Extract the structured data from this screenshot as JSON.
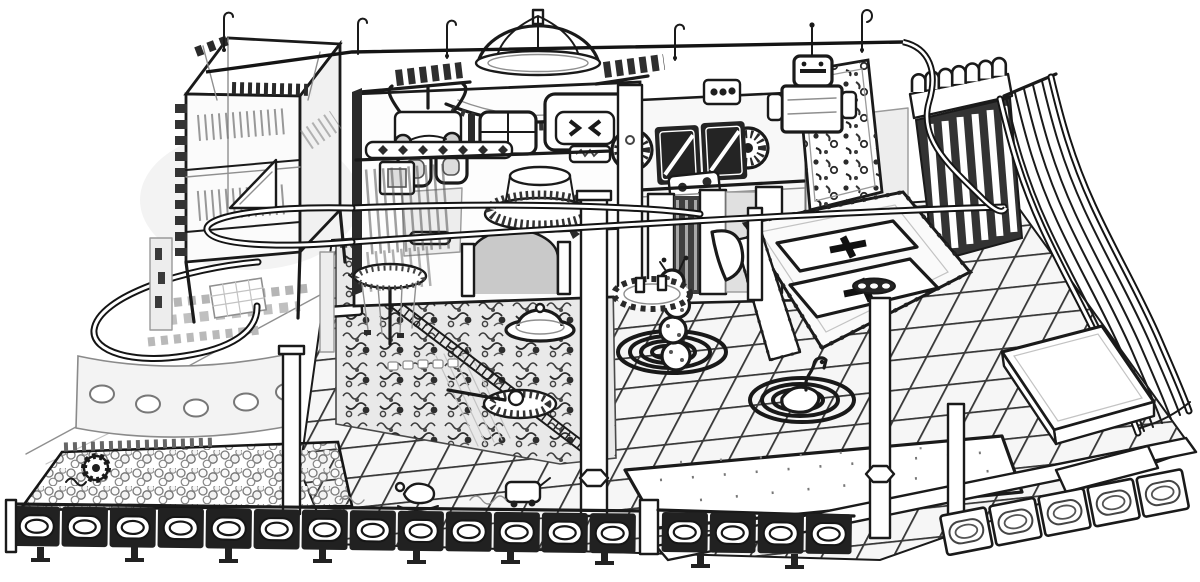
{
  "meta": {
    "description": "Black-and-white pencil edge-sketch of an indoor soft-play playground viewed in isometric perspective",
    "style": "line-art sketch",
    "background": "#ffffff",
    "ink": "#1a1a1a",
    "faint_ink": "#8f8f8f"
  },
  "labels": {
    "panel_number": "20"
  },
  "scene": {
    "regions": [
      {
        "name": "frame-tower",
        "desc": "Open steel-frame play tower with mesh walls, corner braces and interior ramp (top left)"
      },
      {
        "name": "zipline-track",
        "desc": "Overhead glider track that loops around the tower and runs across to the slide tower, with hook hanger posts"
      },
      {
        "name": "dome-playhouse",
        "desc": "Central playhouse facade topped by a ribbed observatory dome with scalloped awning"
      },
      {
        "name": "totem-figure",
        "desc": "Robot-totem decorative column with goggle eyes on the left of the facade"
      },
      {
        "name": "activity-panels",
        "desc": "Busy-board panels: spinner fan wheels, dark slash panels, diamond strip, fluted drum, numbered panel"
      },
      {
        "name": "robot-figure",
        "desc": "Boxy robot figure standing on the upper deck"
      },
      {
        "name": "climbing-wall",
        "desc": "Climbing wall covered with scattered holds"
      },
      {
        "name": "battlement-wall",
        "desc": "Crenellated (round merlon) wall above the slide start with pole forest below"
      },
      {
        "name": "wave-slide",
        "desc": "Multi-lane wave slide sweeping to the lower right corner"
      },
      {
        "name": "landing-mat",
        "desc": "White crash mat slab at the slide run-out"
      },
      {
        "name": "trampoline-court",
        "desc": "Two framed trampoline beds with black cross marks and studded padding"
      },
      {
        "name": "ball-pit",
        "desc": "Ball pit filled with balls and a toothed paddle wheel (lower left)"
      },
      {
        "name": "toddler-deck",
        "desc": "Curved toddler deck with dark U-shaped rail, mosaic tiles and porthole wall"
      },
      {
        "name": "garden-zone",
        "desc": "Dense sensory play garden crossed by a chain-link rope bridge"
      },
      {
        "name": "tile-floor",
        "desc": "Isometric checkerboard of padded floor tiles"
      },
      {
        "name": "spiral-rugs",
        "desc": "Bold spiral rugs with a caterpillar ball stacker and a swan ride-on"
      },
      {
        "name": "ufo-spinner",
        "desc": "Flying-saucer spinner and flat gear carousel"
      },
      {
        "name": "palm-carousel",
        "desc": "Palm-canopy rope carousel"
      },
      {
        "name": "perimeter-fence",
        "desc": "Low perimeter fence of dark panels with oval windows and anchor feet"
      },
      {
        "name": "support-posts",
        "desc": "White structural posts with hex collars holding the track"
      }
    ]
  }
}
